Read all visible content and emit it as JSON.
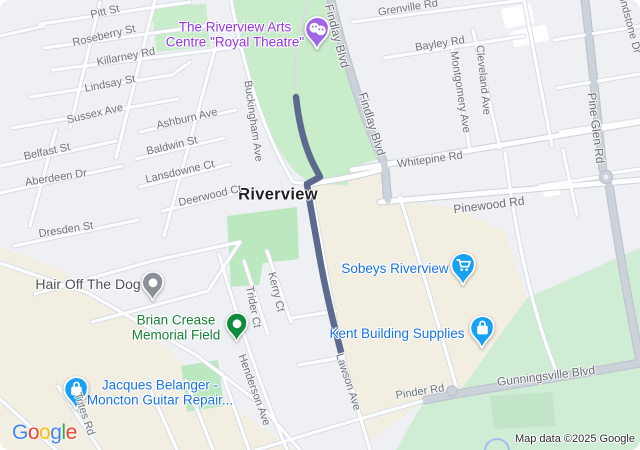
{
  "attribution": "Map data ©2025 Google",
  "city": {
    "label": "Riverview"
  },
  "pois": {
    "arts": {
      "line1": "The Riverview Arts",
      "line2": "Centre \"Royal Theatre\""
    },
    "sobeys": {
      "line1": "Sobeys Riverview"
    },
    "kent": {
      "line1": "Kent Building Supplies"
    },
    "jacques": {
      "line1": "Jacques Belanger -",
      "line2": "Moncton Guitar Repair..."
    },
    "hair": {
      "line1": "Hair Off The Dog"
    },
    "brian": {
      "line1": "Brian Crease",
      "line2": "Memorial Field"
    }
  },
  "streets": [
    {
      "t": "Pitt St",
      "x": 105,
      "y": 12,
      "r": -13
    },
    {
      "t": "Roseberry St",
      "x": 104,
      "y": 36,
      "r": -13
    },
    {
      "t": "Killarney Rd",
      "x": 126,
      "y": 57,
      "r": -11
    },
    {
      "t": "Lindsay St",
      "x": 110,
      "y": 84,
      "r": -11
    },
    {
      "t": "Sussex Ave",
      "x": 95,
      "y": 114,
      "r": -13
    },
    {
      "t": "Ashburn Ave",
      "x": 187,
      "y": 119,
      "r": -13
    },
    {
      "t": "Belfast St",
      "x": 47,
      "y": 152,
      "r": -12
    },
    {
      "t": "Baldwin St",
      "x": 172,
      "y": 146,
      "r": -13
    },
    {
      "t": "Aberdeen Dr",
      "x": 56,
      "y": 178,
      "r": -9
    },
    {
      "t": "Lansdowne Ct",
      "x": 180,
      "y": 172,
      "r": -13
    },
    {
      "t": "Deerwood Ct",
      "x": 210,
      "y": 196,
      "r": -13
    },
    {
      "t": "Dresden St",
      "x": 66,
      "y": 230,
      "r": -9
    },
    {
      "t": "Buckingham Ave",
      "x": 253,
      "y": 121,
      "r": 82
    },
    {
      "t": "Findlay Blvd",
      "x": 337,
      "y": 36,
      "r": 75,
      "m": 1
    },
    {
      "t": "Findlay Blvd",
      "x": 372,
      "y": 124,
      "r": 73,
      "m": 1
    },
    {
      "t": "Grenville Rd",
      "x": 408,
      "y": 8,
      "r": -9
    },
    {
      "t": "Bayley Rd",
      "x": 440,
      "y": 44,
      "r": -9
    },
    {
      "t": "Montgomery Ave",
      "x": 460,
      "y": 92,
      "r": 81
    },
    {
      "t": "Cleveland Ave",
      "x": 483,
      "y": 80,
      "r": 84
    },
    {
      "t": "indstone Dr",
      "x": 630,
      "y": 26,
      "r": 75
    },
    {
      "t": "Pine Glen Rd",
      "x": 596,
      "y": 128,
      "r": 83,
      "m": 1
    },
    {
      "t": "Whitepine Rd",
      "x": 430,
      "y": 160,
      "r": -8
    },
    {
      "t": "Pinewood Rd",
      "x": 489,
      "y": 205,
      "r": -7,
      "m": 1
    },
    {
      "t": "Kerry Ct",
      "x": 276,
      "y": 292,
      "r": 76
    },
    {
      "t": "Trider Ct",
      "x": 253,
      "y": 307,
      "r": 79
    },
    {
      "t": "Henderson Ave",
      "x": 254,
      "y": 390,
      "r": 70
    },
    {
      "t": "Lawson Ave",
      "x": 348,
      "y": 382,
      "r": 72
    },
    {
      "t": "Pinder Rd",
      "x": 420,
      "y": 392,
      "r": -9
    },
    {
      "t": "Gunningsville Blvd",
      "x": 546,
      "y": 376,
      "r": -7,
      "m": 1
    },
    {
      "t": "Trites Rd",
      "x": 84,
      "y": 414,
      "r": 71
    }
  ],
  "logo_letters": [
    {
      "ch": "G",
      "color": "#4285F4"
    },
    {
      "ch": "o",
      "color": "#EA4335"
    },
    {
      "ch": "o",
      "color": "#FBBC05"
    },
    {
      "ch": "g",
      "color": "#4285F4"
    },
    {
      "ch": "l",
      "color": "#34A853"
    },
    {
      "ch": "e",
      "color": "#EA4335"
    }
  ],
  "colors": {
    "bg": "#eef0f4",
    "commercial": "#f2eee1",
    "park": "#c9ecca",
    "park_bright": "#bce8c0",
    "park_se": "#cfecd4",
    "route": "#5c6b8d",
    "poi_blue": "#1a73e8",
    "poi_green": "#188038",
    "poi_purple": "#9334e6",
    "pin_blue": "#18a0f2",
    "pin_purple": "#a166e8",
    "pin_green": "#0f8a3e",
    "pin_gray": "#8a9097"
  }
}
